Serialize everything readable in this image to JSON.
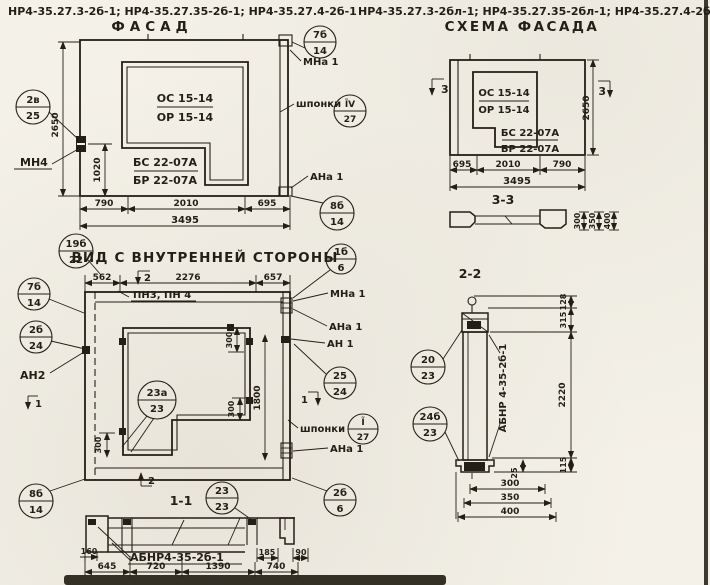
{
  "paper": "#f4f1e8",
  "ink": "#241f16",
  "header": {
    "left_codes": "НР4-35.27.3-2б-1; НР4-35.27.35-2б-1; НР4-35.27.4-2б-1",
    "facade_title": "ФАСАД",
    "right_codes": "НР4-35.27.3-2бл-1; НР4-35.27.35-2бл-1; НР4-35.27.4-2бл-1",
    "scheme_title": "СХЕМА ФАСАДА"
  },
  "facade": {
    "os": "ОС 15-14",
    "op": "ОР 15-14",
    "bs": "БС 22-07А",
    "bp": "БР 22-07А",
    "mn4": "МН4",
    "mna1": "МНа 1",
    "shponki": "шпонки",
    "ana1": "АНа 1",
    "dim_height": "2650",
    "dim_1020": "1020",
    "dim_790": "790",
    "dim_2010": "2010",
    "dim_695": "695",
    "dim_total": "3495",
    "c1t": "2в",
    "c1b": "25",
    "c2t": "7б",
    "c2b": "14",
    "c3t": "ĨV",
    "c3b": "27",
    "c4t": "8б",
    "c4b": "14"
  },
  "scheme": {
    "os": "ОС 15-14",
    "op": "ОР 15-14",
    "bs": "БС 22-07А",
    "bp": "БР 22-07А",
    "dim_695": "695",
    "dim_2010": "2010",
    "dim_790": "790",
    "dim_total": "3495",
    "dim_height": "2650",
    "flag": "3",
    "sec_title": "3-3",
    "d300": "300",
    "d350": "350",
    "d400": "400"
  },
  "inner": {
    "title": "ВИД С ВНУТРЕННЕЙ СТОРОНЫ",
    "ct": "19б",
    "cb": "22",
    "dim_562": "562",
    "dim_2276": "2276",
    "dim_657": "657",
    "pn": "ПН3, ПН 4",
    "flag2": "2",
    "flag1": "1",
    "c7t": "7б",
    "c7b": "14",
    "c2bt": "2б",
    "c2bb": "24",
    "an2": "АН2",
    "c1bt": "1б",
    "c1bb": "6",
    "mna1": "МНа 1",
    "ana1": "АНа 1",
    "an1": "АН 1",
    "c25t": "25",
    "c25b": "24",
    "shponki": "шпонки",
    "csht": "Ĩ",
    "cshb": "27",
    "ana1b": "АНа 1",
    "c23t": "23а",
    "c23b": "23",
    "d300a": "300",
    "d300b": "300",
    "d300c": "300",
    "d1800": "1800",
    "c8t": "8б",
    "c8b": "14",
    "c26t": "2б",
    "c26b": "6"
  },
  "sec11": {
    "title": "1-1",
    "ct": "23",
    "cb": "23",
    "label": "АБНР4-35-2б-1",
    "d160": "160",
    "d645": "645",
    "d720": "720",
    "d1390": "1390",
    "d740": "740",
    "d185": "185",
    "d90": "90"
  },
  "sec22": {
    "title": "2-2",
    "c1t": "20",
    "c1b": "23",
    "c2t": "24б",
    "c2b": "23",
    "label": "АБНР 4-35-2б-1",
    "d128": "128",
    "d315": "315",
    "d2220": "2220",
    "d115": "115",
    "d25": "25",
    "d300": "300",
    "d350": "350",
    "d400": "400"
  }
}
